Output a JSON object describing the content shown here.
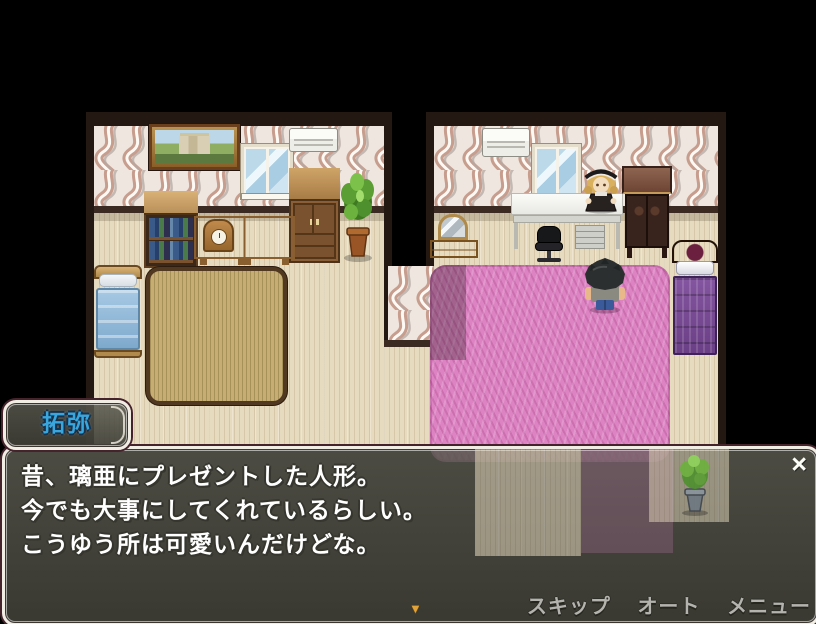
{
  "name_box": {
    "text": "拓弥"
  },
  "dialog": {
    "lines": [
      "昔、璃亜にプレゼントした人形。",
      "今でも大事にしてくれているらしい。",
      "こうゆう所は可愛いんだけどな。"
    ],
    "close_label": "×",
    "continue_indicator": "▼"
  },
  "menu": {
    "items": [
      {
        "label": "スキップ"
      },
      {
        "label": "オート"
      },
      {
        "label": "メニュー"
      }
    ]
  },
  "colors": {
    "name_text": "#3aa6de",
    "dialog_text": "#ffffff",
    "menu_text": "#b5b3ae",
    "continue_arrow": "#e2a438",
    "window_border": "#f2ede4",
    "pink_rug": "#dd83c3",
    "tatami_rug": "#c6ad72"
  }
}
